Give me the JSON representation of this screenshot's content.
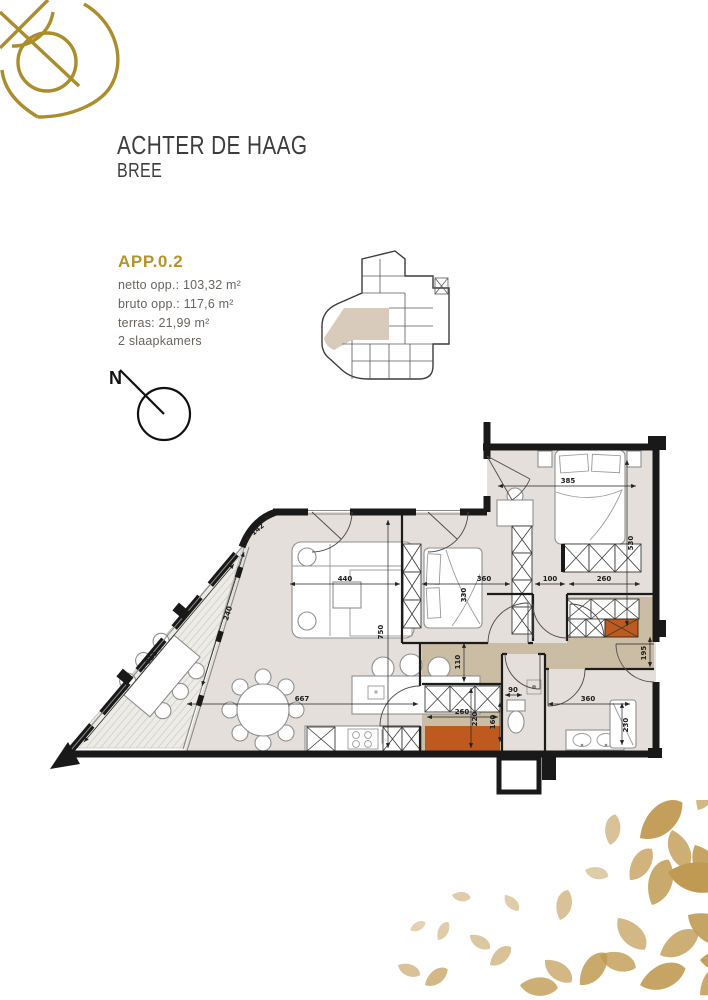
{
  "page": {
    "title": "ACHTER DE HAAG",
    "subtitle": "BREE"
  },
  "unit": {
    "code": "APP.0.2",
    "netto_label": "netto opp.: 103,32 m²",
    "bruto_label": "bruto opp.: 117,6 m²",
    "terras_label": "terras: 21,99 m²",
    "bedrooms_label": "2 slaapkamers"
  },
  "compass": {
    "label": "N"
  },
  "colors": {
    "gold": "#ab8d2c",
    "text_gold": "#b5942c",
    "leaf": "#c09a52",
    "wall": "#191919",
    "floor": "#e5dfdb",
    "hall": "#cabda3",
    "terrace": "#edebe6",
    "hatch": "#c2bdb6",
    "orange": "#bf5a1e",
    "site_highlight": "#d8cbbc"
  },
  "floorplan": {
    "dimension_labels": [
      {
        "t": "440",
        "x": 295,
        "y": 167,
        "r": 0
      },
      {
        "t": "330",
        "x": 416,
        "y": 181,
        "r": -90
      },
      {
        "t": "360",
        "x": 434,
        "y": 167,
        "r": 0
      },
      {
        "t": "100",
        "x": 500,
        "y": 167,
        "r": 0
      },
      {
        "t": "260",
        "x": 554,
        "y": 167,
        "r": 0
      },
      {
        "t": "385",
        "x": 518,
        "y": 69,
        "r": 0
      },
      {
        "t": "530",
        "x": 583,
        "y": 129,
        "r": -90
      },
      {
        "t": "750",
        "x": 333,
        "y": 218,
        "r": -90
      },
      {
        "t": "110",
        "x": 410,
        "y": 248,
        "r": -90
      },
      {
        "t": "667",
        "x": 252,
        "y": 287,
        "r": 0
      },
      {
        "t": "260",
        "x": 412,
        "y": 300,
        "r": 0
      },
      {
        "t": "220",
        "x": 427,
        "y": 305,
        "r": -90
      },
      {
        "t": "90",
        "x": 463,
        "y": 278,
        "r": 0
      },
      {
        "t": "160",
        "x": 445,
        "y": 308,
        "r": -90
      },
      {
        "t": "360",
        "x": 538,
        "y": 287,
        "r": 0
      },
      {
        "t": "230",
        "x": 578,
        "y": 311,
        "r": -90
      },
      {
        "t": "195",
        "x": 596,
        "y": 239,
        "r": -90
      },
      {
        "t": "811",
        "x": 103,
        "y": 245,
        "r": -51
      },
      {
        "t": "240",
        "x": 180,
        "y": 200,
        "r": -72
      },
      {
        "t": "142",
        "x": 209,
        "y": 117,
        "r": -40
      }
    ]
  }
}
